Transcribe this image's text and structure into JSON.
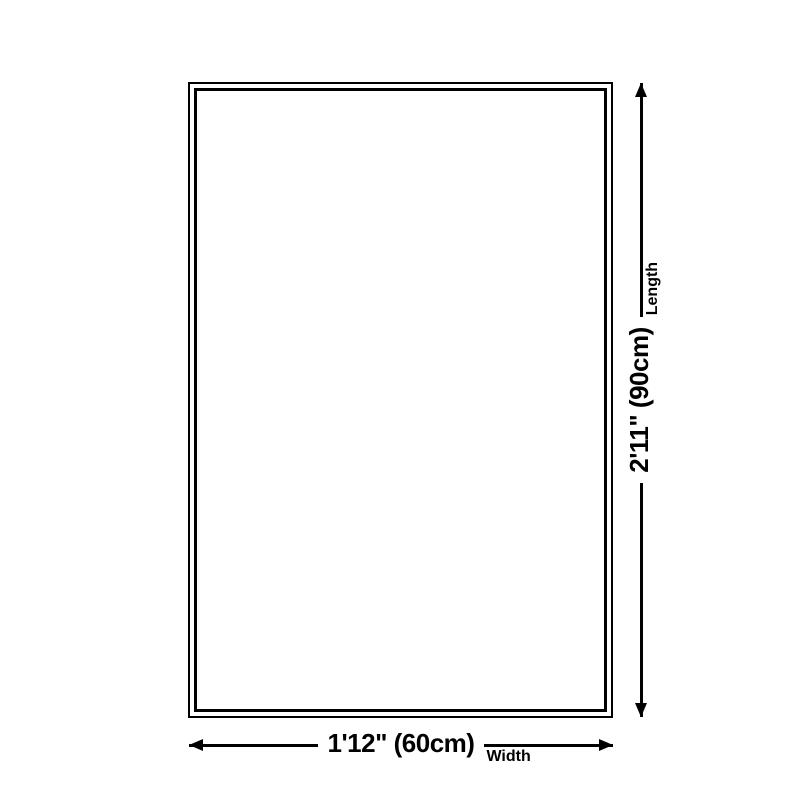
{
  "diagram": {
    "background_color": "#ffffff",
    "line_color": "#000000",
    "dimensions": {
      "width": {
        "value": "1'12\" (60cm)",
        "label": "Width"
      },
      "length": {
        "value": "2'11\" (90cm)",
        "label": "Length"
      }
    },
    "icons": {
      "arrow_left": "triangle-left",
      "arrow_right": "triangle-right",
      "arrow_up": "triangle-up",
      "arrow_down": "triangle-down"
    }
  }
}
